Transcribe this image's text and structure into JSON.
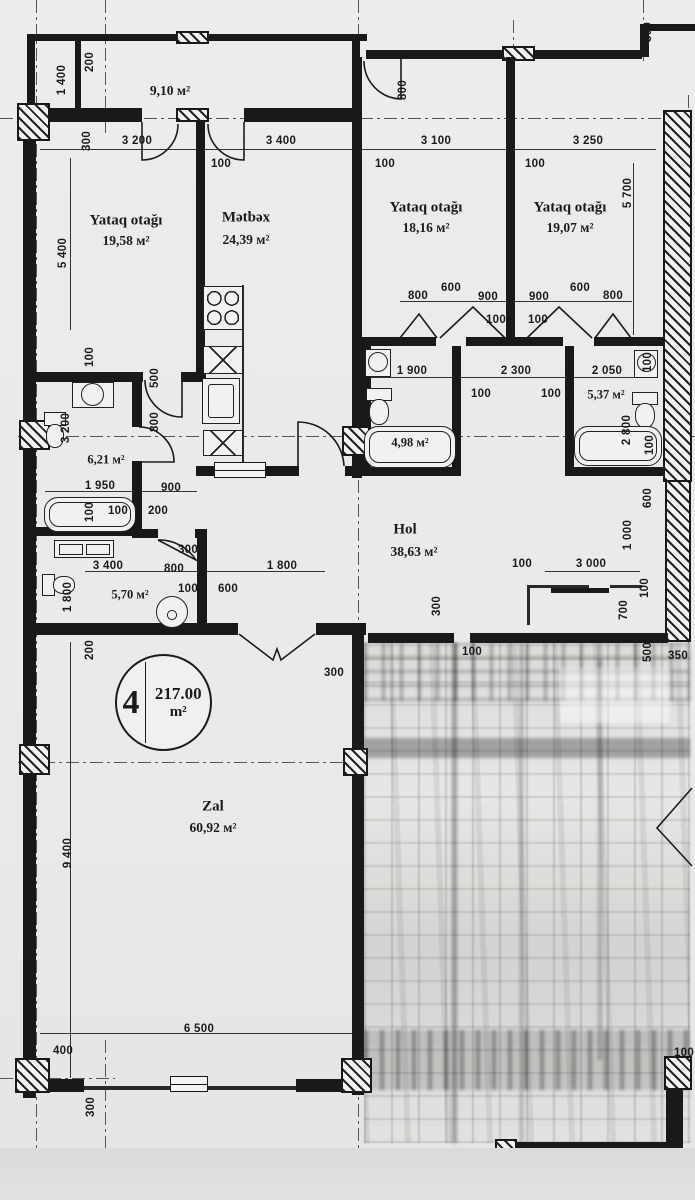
{
  "stamp": {
    "number": "4",
    "area": "217.00",
    "unit": "m²"
  },
  "rooms": {
    "balcony": {
      "area": "9,10 м²"
    },
    "bedroom1": {
      "name": "Yataq otağı",
      "area": "19,58 м²"
    },
    "kitchen": {
      "name": "Mətbəx",
      "area": "24,39 м²"
    },
    "bedroom2": {
      "name": "Yataq otağı",
      "area": "18,16 м²"
    },
    "bedroom3": {
      "name": "Yataq otağı",
      "area": "19,07 м²"
    },
    "bath1": {
      "area": "6,21 м²"
    },
    "bath2": {
      "area": "4,98 м²"
    },
    "bath3": {
      "area": "5,37 м²"
    },
    "wc": {
      "area": "5,70 м²"
    },
    "hall": {
      "name": "Hol",
      "area": "38,63 м²"
    },
    "living": {
      "name": "Zal",
      "area": "60,92 м²"
    }
  },
  "dims": {
    "d01": "1 400",
    "d02": "200",
    "d03": "800",
    "d04": "300",
    "d05": "300",
    "d06": "3 200",
    "d07": "3 400",
    "d08": "3 100",
    "d09": "3 250",
    "d10": "100",
    "d11": "100",
    "d12": "100",
    "d13": "5 400",
    "d14": "5 700",
    "d15": "800",
    "d16": "600",
    "d17": "900",
    "d18": "900",
    "d19": "600",
    "d20": "800",
    "d21": "100",
    "d22": "100",
    "d23": "100",
    "d24": "500",
    "d25": "800",
    "d26": "3 200",
    "d27": "1 900",
    "d28": "2 300",
    "d29": "2 050",
    "d30": "100",
    "d31": "100",
    "d32": "100",
    "d33": "2 800",
    "d34": "100",
    "d35": "1 950",
    "d36": "900",
    "d37": "100",
    "d38": "100",
    "d39": "200",
    "d40": "600",
    "d41": "1 000",
    "d42": "300",
    "d43": "3 400",
    "d44": "800",
    "d45": "1 800",
    "d46": "100",
    "d47": "600",
    "d48": "1 800",
    "d49": "100",
    "d50": "3 000",
    "d51": "300",
    "d52": "700",
    "d53": "100",
    "d54": "500",
    "d55": "350",
    "d56": "100",
    "d57": "200",
    "d58": "300",
    "d59": "9 400",
    "d60": "6 500",
    "d61": "400",
    "d62": "300",
    "d63": "100"
  },
  "colors": {
    "paper": "#e9e9e7",
    "ink": "#1b1b1b"
  }
}
